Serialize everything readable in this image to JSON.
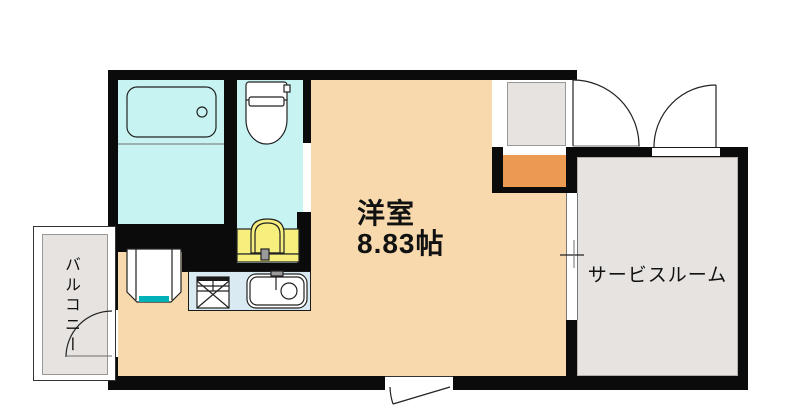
{
  "window": {
    "width": 800,
    "height": 419
  },
  "labels": {
    "main_room_name": "洋室",
    "main_room_size": "8.83帖",
    "service_room": "サービスルーム",
    "balcony": "バルコニー"
  },
  "colors": {
    "wall": "#0b0b0b",
    "floor_main": "#f7d9ad",
    "floor_wet": "#c7f4f2",
    "floor_gray": "#e6e3e1",
    "counter_blue": "#daeaf2",
    "fixture_yellow": "#f6ef7e",
    "cabinet_orange": "#ec9a52",
    "drain_teal": "#00b2b8",
    "outline": "#222222"
  }
}
